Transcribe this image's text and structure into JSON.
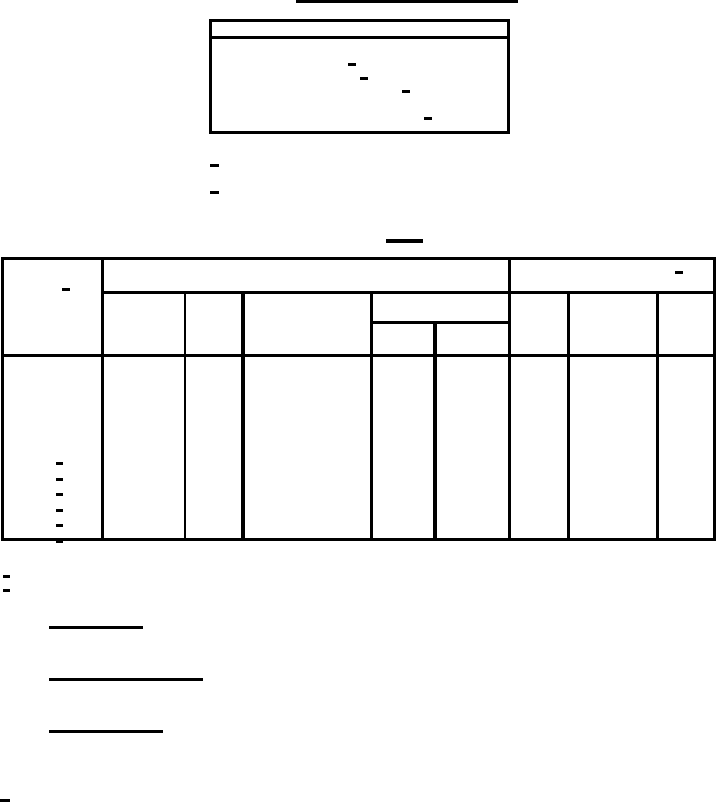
{
  "colors": {
    "ink": "#000000",
    "paper": "#ffffff"
  },
  "page": {
    "width": 720,
    "height": 803,
    "kind": "scanned-blank-form"
  },
  "marks": {
    "rules": [
      {
        "name": "top-title-rule",
        "x": 296,
        "y": 0,
        "w": 222,
        "h": 3
      },
      {
        "name": "section-rule",
        "x": 386,
        "y": 239,
        "w": 37,
        "h": 4
      },
      {
        "name": "signature-rule-1",
        "x": 49,
        "y": 626,
        "w": 94,
        "h": 3
      },
      {
        "name": "signature-rule-2",
        "x": 49,
        "y": 678,
        "w": 154,
        "h": 3
      },
      {
        "name": "signature-rule-3",
        "x": 49,
        "y": 730,
        "w": 114,
        "h": 3
      }
    ],
    "boxes": [
      {
        "name": "header-box",
        "x": 209,
        "y": 19,
        "w": 301,
        "h": 115,
        "t": 3
      }
    ],
    "box_lines": [
      {
        "name": "header-box-divider",
        "x": 209,
        "y": 36,
        "w": 301,
        "h": 3
      }
    ],
    "dashes": [
      {
        "name": "header-box-dash-1",
        "x": 348,
        "y": 63,
        "w": 8,
        "h": 3
      },
      {
        "name": "header-box-dash-2",
        "x": 360,
        "y": 77,
        "w": 8,
        "h": 3
      },
      {
        "name": "header-box-dash-3",
        "x": 402,
        "y": 90,
        "w": 8,
        "h": 3
      },
      {
        "name": "header-box-dash-4",
        "x": 424,
        "y": 117,
        "w": 8,
        "h": 3
      },
      {
        "name": "note-dash-1",
        "x": 210,
        "y": 164,
        "w": 9,
        "h": 3
      },
      {
        "name": "note-dash-2",
        "x": 210,
        "y": 191,
        "w": 9,
        "h": 3
      },
      {
        "name": "table-col1-header-dash",
        "x": 62,
        "y": 288,
        "w": 8,
        "h": 3
      },
      {
        "name": "table-right-header-dash",
        "x": 675,
        "y": 271,
        "w": 8,
        "h": 3
      },
      {
        "name": "table-row-dash-1",
        "x": 56,
        "y": 462,
        "w": 7,
        "h": 3
      },
      {
        "name": "table-row-dash-2",
        "x": 56,
        "y": 478,
        "w": 7,
        "h": 3
      },
      {
        "name": "table-row-dash-3",
        "x": 56,
        "y": 493,
        "w": 7,
        "h": 3
      },
      {
        "name": "table-row-dash-4",
        "x": 56,
        "y": 509,
        "w": 7,
        "h": 3
      },
      {
        "name": "table-row-dash-5",
        "x": 56,
        "y": 524,
        "w": 7,
        "h": 3
      },
      {
        "name": "table-row-dash-6",
        "x": 56,
        "y": 540,
        "w": 7,
        "h": 3
      },
      {
        "name": "footnote-dash-1",
        "x": 3,
        "y": 575,
        "w": 7,
        "h": 3
      },
      {
        "name": "footnote-dash-2",
        "x": 3,
        "y": 589,
        "w": 7,
        "h": 3
      },
      {
        "name": "page-bottom-dash",
        "x": 0,
        "y": 799,
        "w": 10,
        "h": 3
      }
    ]
  },
  "table": {
    "outer": {
      "name": "data-table-border",
      "x": 1,
      "y": 257,
      "w": 715,
      "h": 284,
      "t": 3
    },
    "hlines": [
      {
        "name": "table-header-mid-line",
        "x": 101,
        "y": 291,
        "w": 615,
        "h": 3
      },
      {
        "name": "table-subheader-line",
        "x": 370,
        "y": 321,
        "w": 140,
        "h": 3
      },
      {
        "name": "table-header-bottom-line",
        "x": 1,
        "y": 354,
        "w": 715,
        "h": 3
      }
    ],
    "vlines": [
      {
        "name": "table-vline-col1",
        "x": 101,
        "y": 257,
        "w": 3,
        "h": 284
      },
      {
        "name": "table-vline-col2",
        "x": 184,
        "y": 291,
        "w": 2,
        "h": 250
      },
      {
        "name": "table-vline-col3",
        "x": 241,
        "y": 291,
        "w": 4,
        "h": 250
      },
      {
        "name": "table-vline-col4",
        "x": 370,
        "y": 291,
        "w": 3,
        "h": 250
      },
      {
        "name": "table-vline-subcol",
        "x": 433,
        "y": 321,
        "w": 4,
        "h": 220
      },
      {
        "name": "table-vline-col5",
        "x": 508,
        "y": 257,
        "w": 3,
        "h": 284
      },
      {
        "name": "table-vline-col6",
        "x": 567,
        "y": 291,
        "w": 3,
        "h": 250
      },
      {
        "name": "table-vline-col7",
        "x": 656,
        "y": 291,
        "w": 3,
        "h": 250
      }
    ]
  }
}
